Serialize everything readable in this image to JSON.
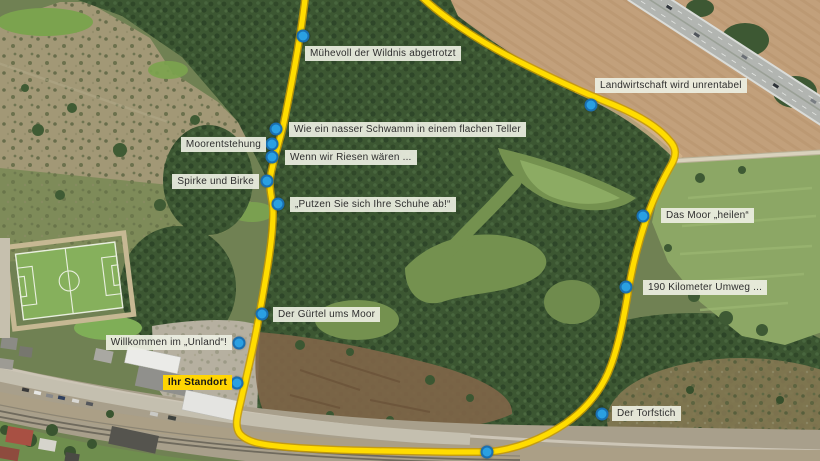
{
  "map": {
    "kind": "aerial-route-map",
    "route_color": "#ffdc00",
    "marker_color": "#2aa0e2",
    "markers": [
      {
        "id": "muehevoll",
        "label": "Mühevoll der Wildnis abgetrotzt"
      },
      {
        "id": "landwirtschaft",
        "label": "Landwirtschaft wird unrentabel"
      },
      {
        "id": "schwamm",
        "label": "Wie ein nasser Schwamm in einem flachen Teller"
      },
      {
        "id": "moorentstehung",
        "label": "Moorentstehung"
      },
      {
        "id": "riesen",
        "label": "Wenn wir Riesen wären ..."
      },
      {
        "id": "spirke",
        "label": "Spirke und Birke"
      },
      {
        "id": "putzen",
        "label": "„Putzen Sie sich Ihre Schuhe ab!“"
      },
      {
        "id": "heilen",
        "label": "Das Moor „heilen“"
      },
      {
        "id": "umweg",
        "label": "190 Kilometer Umweg ..."
      },
      {
        "id": "guertel",
        "label": "Der Gürtel ums Moor"
      },
      {
        "id": "willkommen",
        "label": "Willkommen im „Unland“!"
      },
      {
        "id": "standort",
        "label": "Ihr Standort",
        "highlight": true
      },
      {
        "id": "torfstich",
        "label": "Der Torfstich"
      },
      {
        "id": "route-point",
        "label": ""
      }
    ]
  }
}
